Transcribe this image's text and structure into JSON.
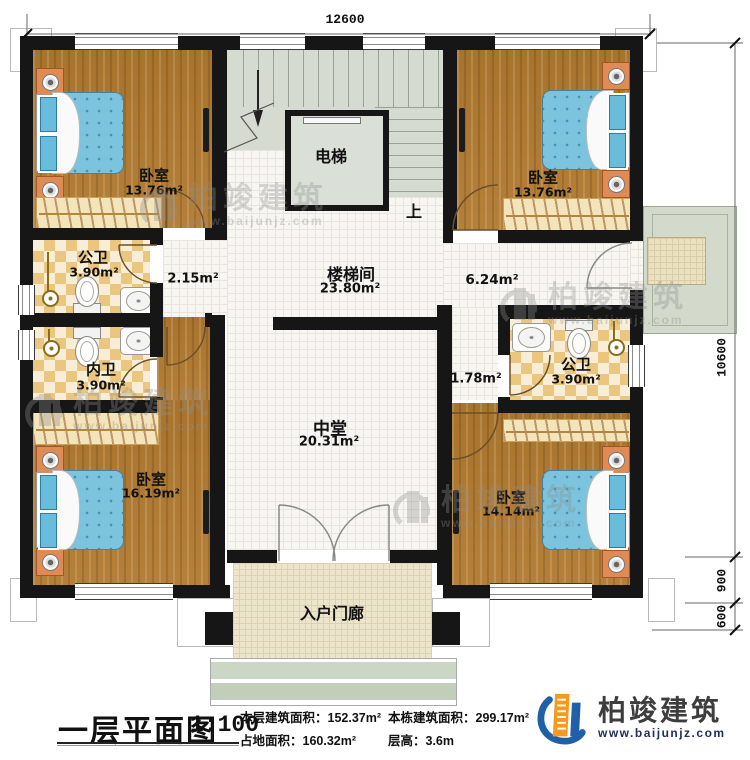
{
  "dims": {
    "top": "12600",
    "right": "10600",
    "porch_depth": "900",
    "steps": "600"
  },
  "rooms": {
    "bedroom_tl": {
      "name": "卧室",
      "area": "13.76m²"
    },
    "bedroom_tr": {
      "name": "卧室",
      "area": "13.76m²"
    },
    "bedroom_bl": {
      "name": "卧室",
      "area": "16.19m²"
    },
    "bedroom_br": {
      "name": "卧室",
      "area": "14.14m²"
    },
    "elevator": {
      "name": "电梯"
    },
    "stairwell": {
      "name": "楼梯间",
      "area": "23.80m²"
    },
    "hall": {
      "name": "中堂",
      "area": "20.31m²"
    },
    "bath_public_left": {
      "name": "公卫",
      "area": "3.90m²"
    },
    "bath_private": {
      "name": "内卫",
      "area": "3.90m²"
    },
    "bath_public_right": {
      "name": "公卫",
      "area": "3.90m²"
    },
    "porch": {
      "name": "入户门廊"
    },
    "corridor_left": {
      "area": "2.15m²"
    },
    "corridor_right": {
      "area": "6.24m²"
    },
    "vestibule": {
      "area": "1.78m²"
    },
    "stairs_up": {
      "label": "上"
    }
  },
  "watermark": {
    "brand": "柏竣建筑",
    "url": "www.baijunjz.com"
  },
  "title_block": {
    "title": "一层平面图",
    "scale": "1:100",
    "stats": [
      "本层建筑面积：152.37m²",
      "占地面积：160.32m²",
      "本栋建筑面积：299.17m²",
      "层高：3.6m"
    ],
    "brand": {
      "name": "柏竣建筑",
      "url": "www.baijunjz.com"
    }
  },
  "colors": {
    "wall": "#161616",
    "wood_floor": "#b1792e",
    "bed_blue": "#7cc4de",
    "bath_checker": "#ebc67f",
    "stair_gray": "#d5dbd1",
    "logo_blue": "#2060a8",
    "logo_orange": "#f59a1d"
  }
}
